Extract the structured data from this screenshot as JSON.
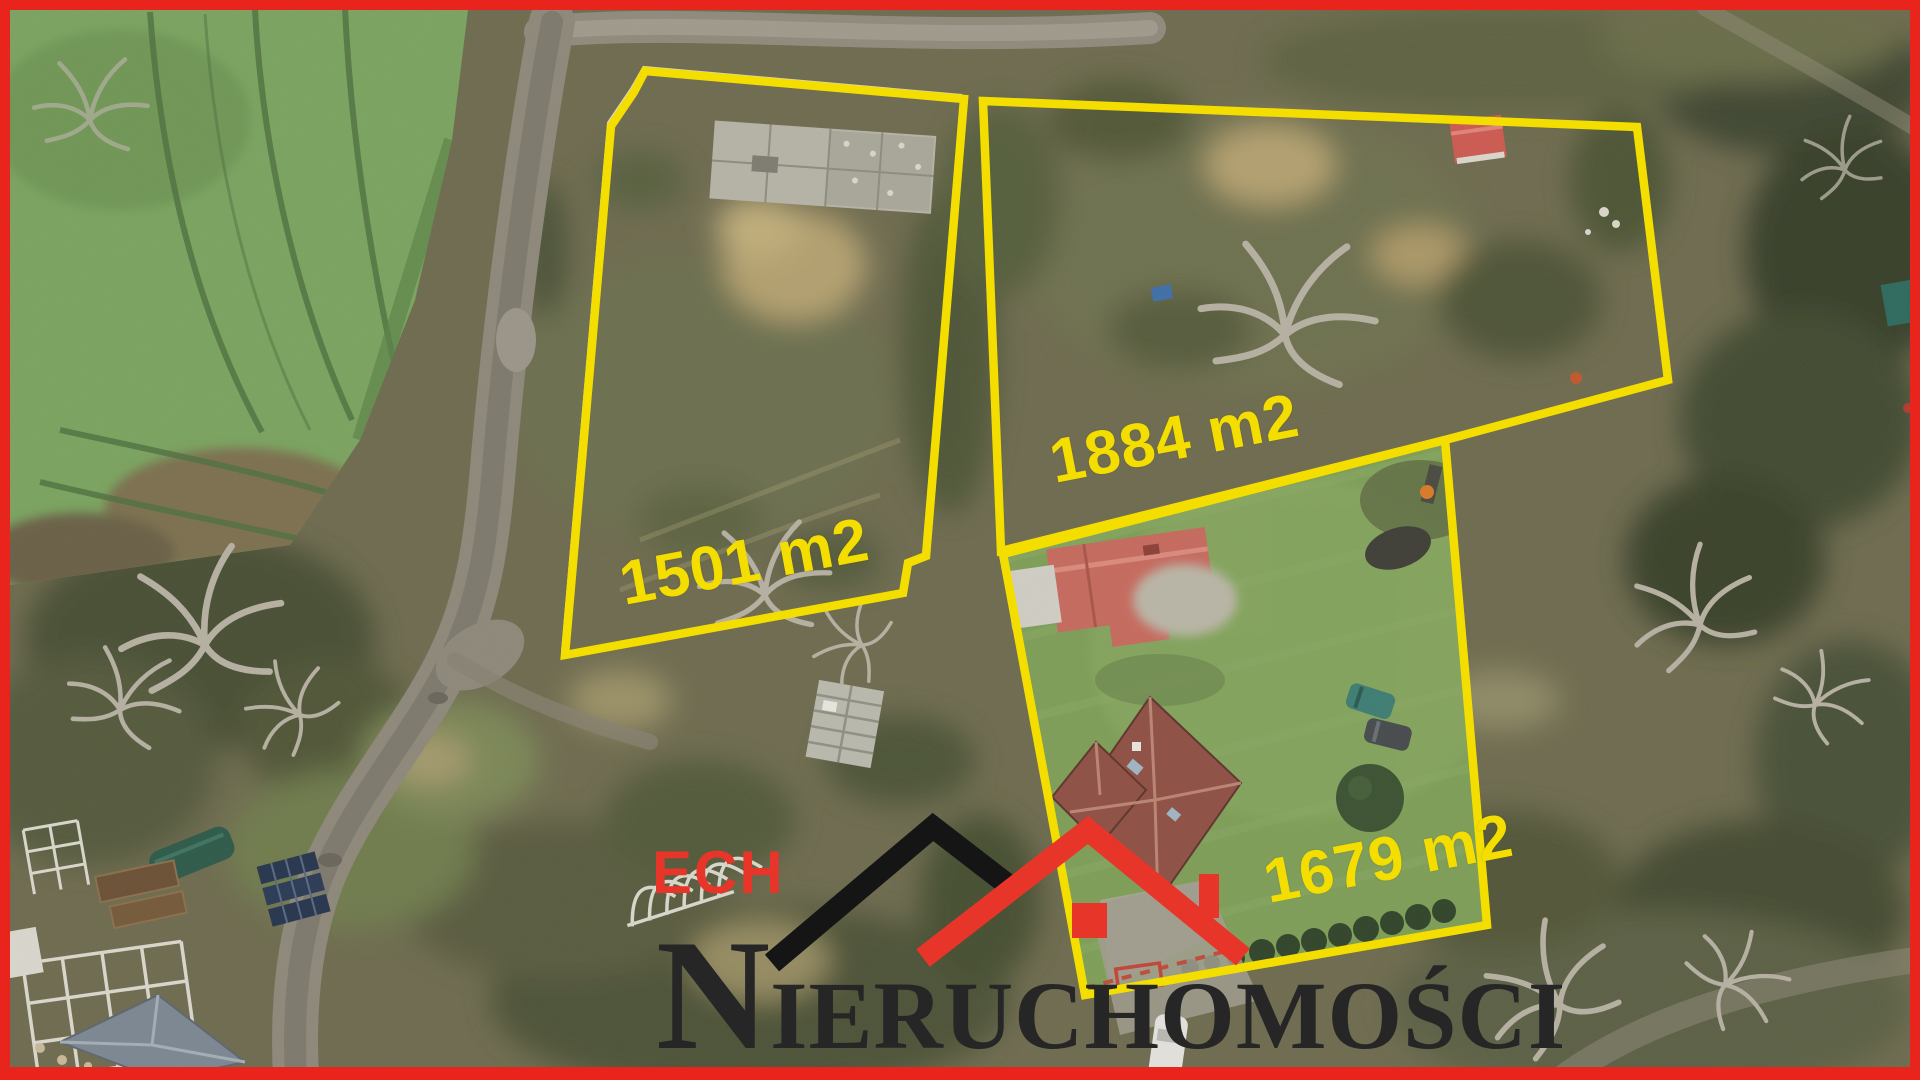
{
  "meta": {
    "kind": "aerial-drone-real-estate-photo",
    "season": "late-autumn"
  },
  "plots": [
    {
      "id": "plot-a",
      "area_m2": 1501,
      "area_label": "1501 m2"
    },
    {
      "id": "plot-b",
      "area_m2": 1884,
      "area_label": "1884 m2"
    },
    {
      "id": "plot-c",
      "area_m2": 1679,
      "area_label": "1679 m2"
    }
  ],
  "watermark": {
    "brand_top": "ECH",
    "brand_name": "NIERUCHOMOŚCI",
    "brand_initial": "N",
    "brand_rest": "IERUCHOMOŚCI"
  },
  "colors": {
    "plot_outline": "#f4de00",
    "frame_red": "#e8241d",
    "logo_red": "#e8352a",
    "logo_dark": "#262626",
    "field_green": "#7aa35f",
    "lawn_green": "#7e9e58",
    "house_roof": "#8f5044",
    "outbuilding_roof": "#c66a5e"
  }
}
